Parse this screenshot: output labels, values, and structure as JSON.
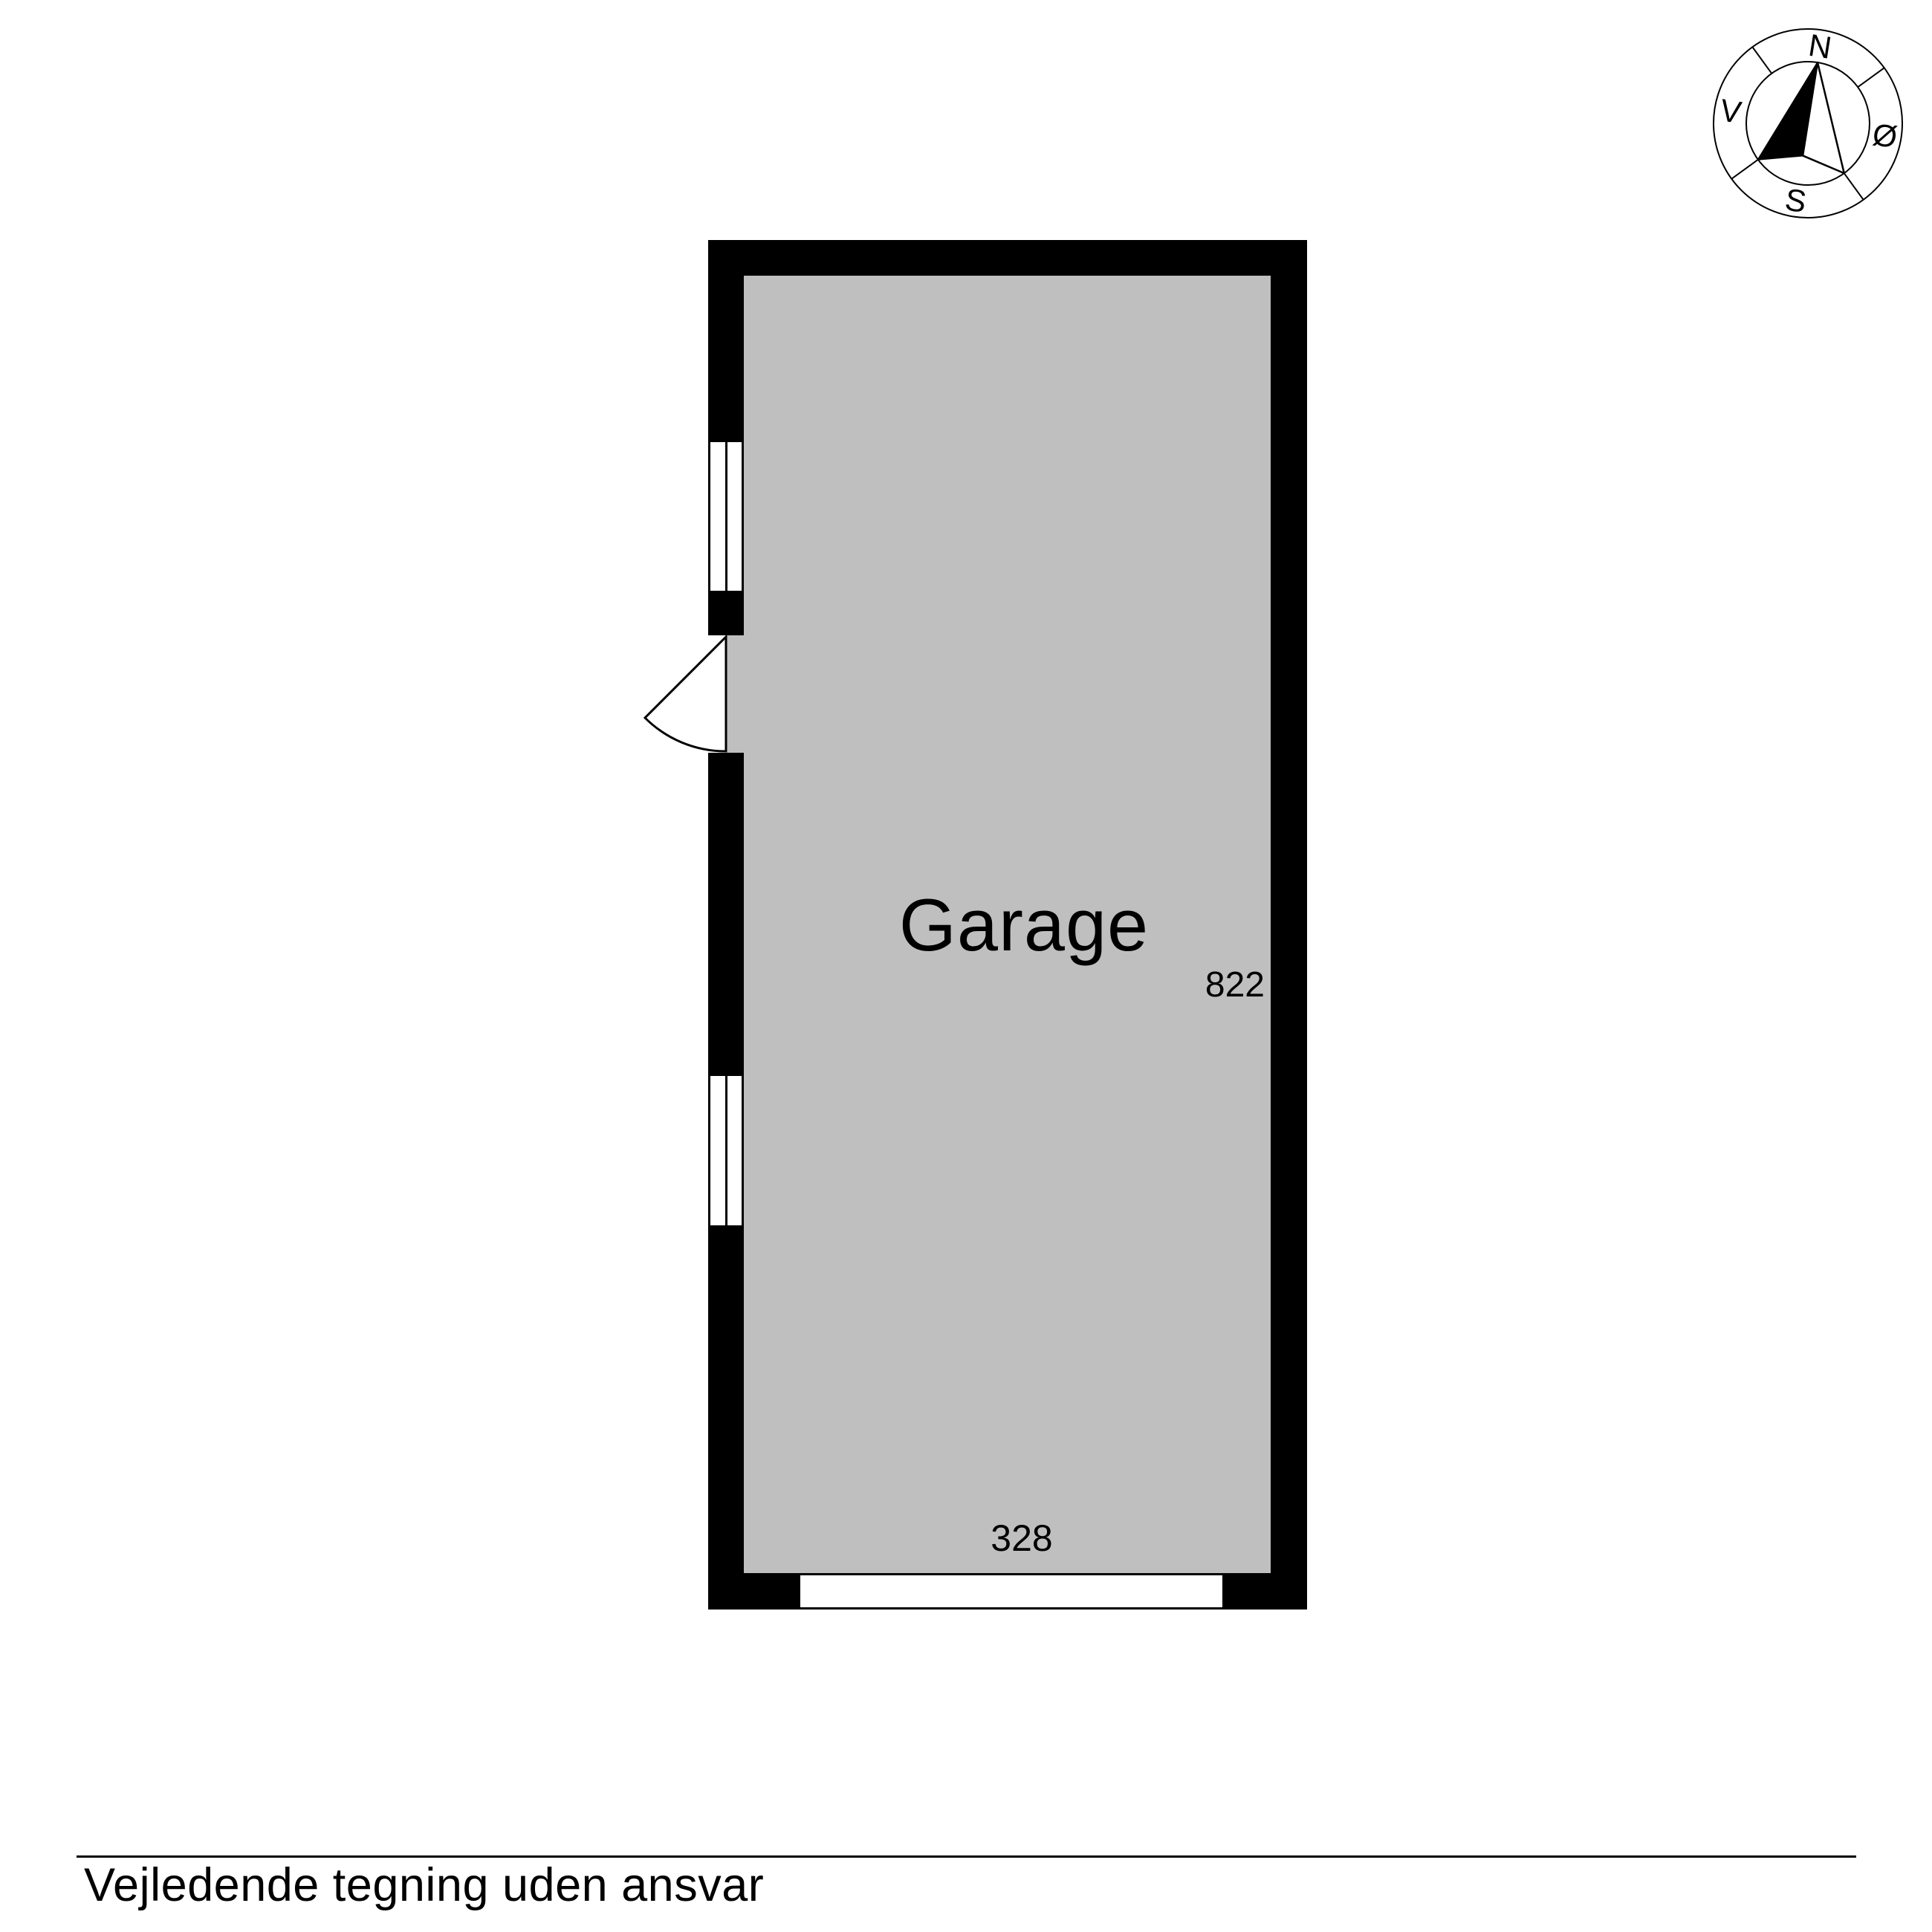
{
  "colors": {
    "background": "#ffffff",
    "wall": "#000000",
    "floor": "#bfbfbf",
    "line": "#000000",
    "text": "#000000"
  },
  "floorplan": {
    "room_label": "Garage",
    "dimensions": {
      "height_cm": "822",
      "width_cm": "328"
    }
  },
  "compass": {
    "north": "N",
    "east": "Ø",
    "south": "S",
    "west": "V"
  },
  "footer": {
    "note": "Vejledende tegning uden ansvar"
  }
}
